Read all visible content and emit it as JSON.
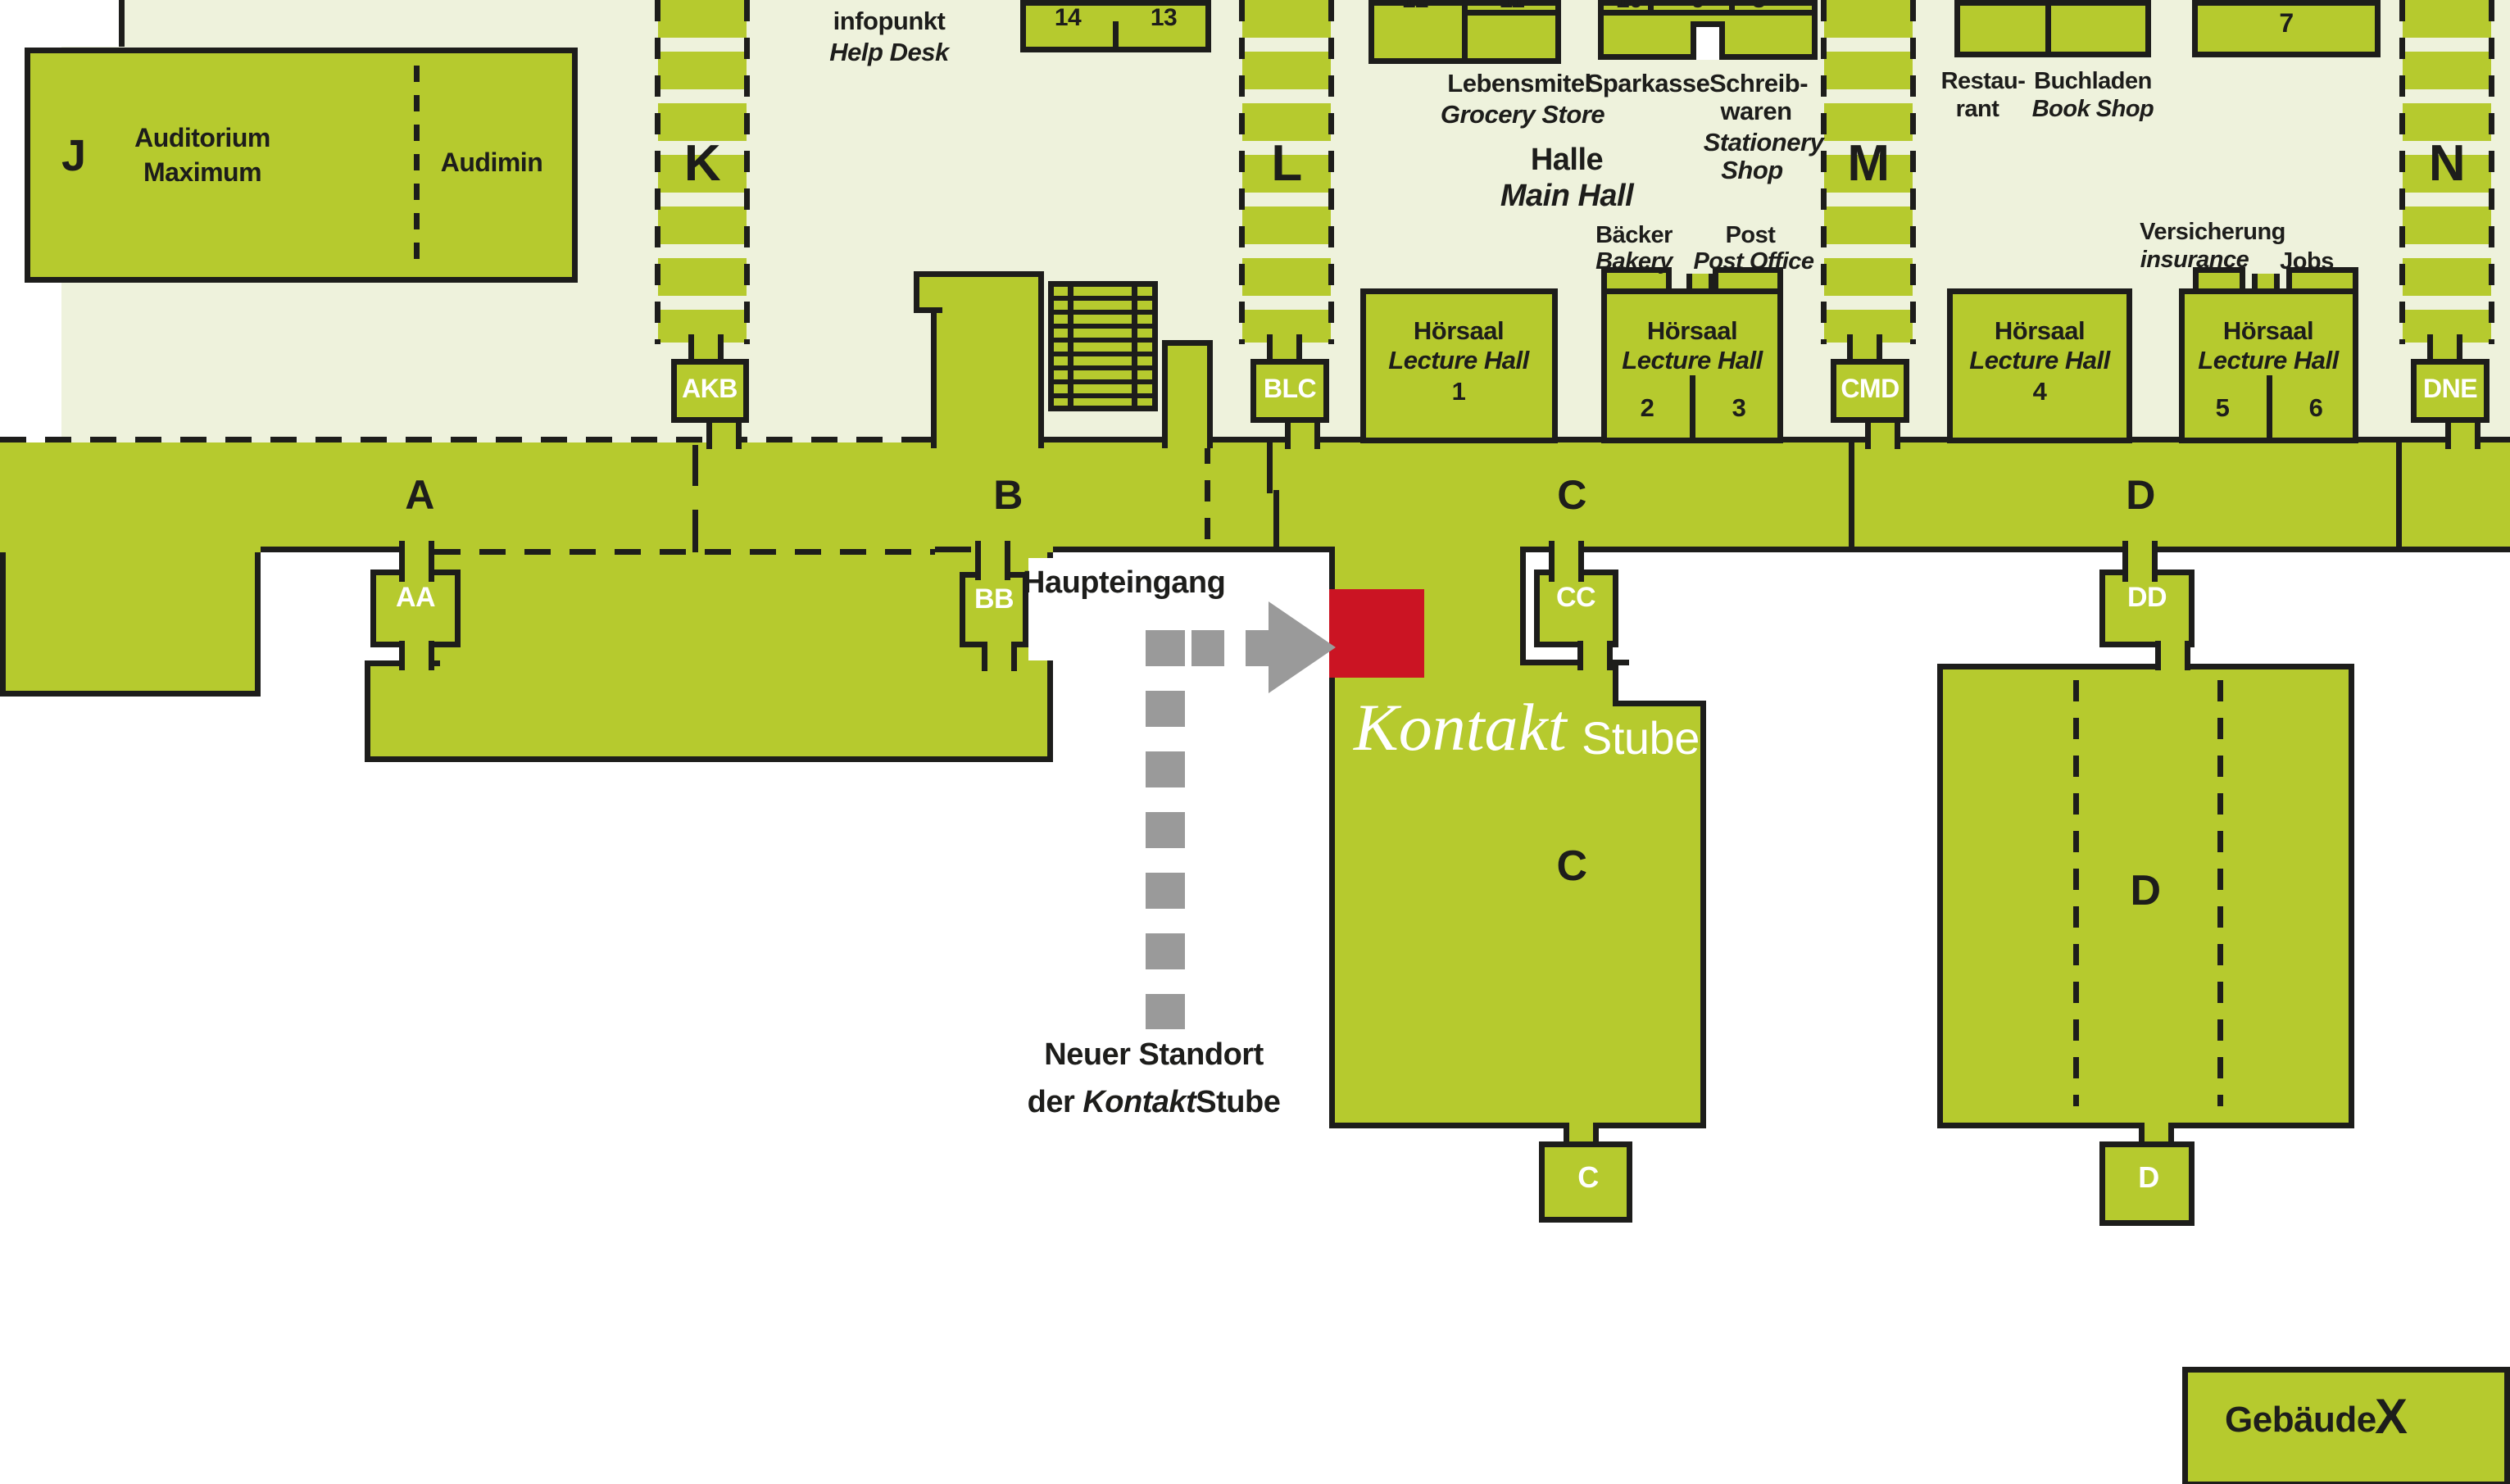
{
  "colors": {
    "green": "#b6ca2e",
    "pale": "#eef2dc",
    "ink": "#1d1d1b",
    "red": "#cb1423",
    "gray": "#9a9a9a"
  },
  "legendBox": {
    "label": "Gebäude",
    "letter": "X"
  },
  "corridor": {
    "a": "A",
    "b": "B",
    "c": "C",
    "d": "D"
  },
  "towers": {
    "k": "K",
    "l": "L",
    "m": "M",
    "n": "N"
  },
  "connectors": {
    "akb": "AKB",
    "blc": "BLC",
    "cmd": "CMD",
    "dne": "DNE",
    "aa": "AA",
    "bb": "BB",
    "cc": "CC",
    "dd": "DD",
    "cSmall": "C",
    "dSmall": "D"
  },
  "wings": {
    "c": "C",
    "d": "D"
  },
  "jBuilding": {
    "letter": "J",
    "name1": "Auditorium",
    "name2": "Maximum",
    "annex": "Audimin"
  },
  "rooms": {
    "n14": "14",
    "n13": "13",
    "n12": "12",
    "n11": "11",
    "n10": "10",
    "n9": "9",
    "n8": "8",
    "n7": "7"
  },
  "hoersaal": {
    "de": "Hörsaal",
    "en": "Lecture Hall",
    "h1": "1",
    "h2": "2",
    "h3": "3",
    "h4": "4",
    "h5": "5",
    "h6": "6"
  },
  "services": {
    "infopunkt": {
      "de": "infopunkt",
      "en": "Help Desk"
    },
    "lebensmittel": {
      "de": "Lebensmitel",
      "en": "Grocery Store"
    },
    "sparkasse": {
      "de": "Sparkasse"
    },
    "schreibwaren": {
      "de1": "Schreib-",
      "de2": "waren",
      "en1": "Stationery",
      "en2": "Shop"
    },
    "halle": {
      "de": "Halle",
      "en": "Main Hall"
    },
    "baecker": {
      "de": "Bäcker",
      "en": "Bakery"
    },
    "post": {
      "de": "Post",
      "en": "Post Office"
    },
    "restaurant": {
      "de1": "Restau-",
      "de2": "rant"
    },
    "buchladen": {
      "de": "Buchladen",
      "en": "Book Shop"
    },
    "versicherung": {
      "de": "Versicherung",
      "en": "insurance"
    },
    "jobs": {
      "de": "Jobs"
    }
  },
  "annotations": {
    "haupteingang": "Haupteingang",
    "logo": {
      "script": "Kontakt",
      "plain": "Stube"
    },
    "newLocation": {
      "line1": "Neuer Standort",
      "pre": "der ",
      "italic": "Kontakt",
      "post": "Stube"
    }
  }
}
